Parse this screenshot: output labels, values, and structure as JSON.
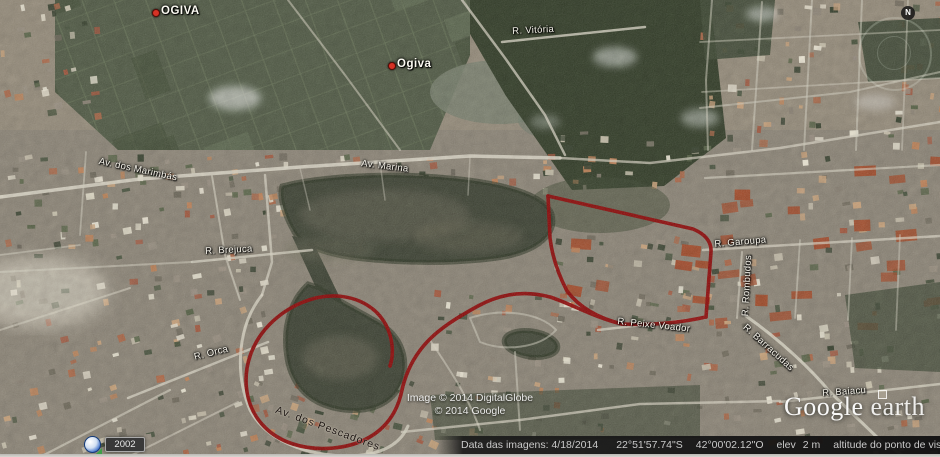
{
  "map": {
    "placemarks": [
      {
        "t": "OGIVA",
        "x": 152,
        "y": 9
      },
      {
        "t": "Ogiva",
        "x": 388,
        "y": 62
      }
    ],
    "street_labels": [
      {
        "t": "Av. dos Marimbás",
        "x": 100,
        "y": 156,
        "r": 12
      },
      {
        "t": "Av. Marina",
        "x": 362,
        "y": 158,
        "r": 7
      },
      {
        "t": "R. Vitória",
        "x": 512,
        "y": 26,
        "r": -3
      },
      {
        "t": "R. Brejuca",
        "x": 205,
        "y": 246,
        "r": -3
      },
      {
        "t": "R. Orca",
        "x": 193,
        "y": 352,
        "r": -14
      },
      {
        "t": "R. Garoupa",
        "x": 714,
        "y": 239,
        "r": -5
      },
      {
        "t": "R. Rombudos",
        "x": 740,
        "y": 316,
        "r": -87
      },
      {
        "t": "R. Peixe Voador",
        "x": 618,
        "y": 316,
        "r": 6
      },
      {
        "t": "R. Barracudas",
        "x": 748,
        "y": 322,
        "r": 42
      },
      {
        "t": "R. Baiacu",
        "x": 822,
        "y": 388,
        "r": -4
      },
      {
        "t": "Av. dos Pescadores",
        "x": 278,
        "y": 404,
        "r": 20,
        "dark": true
      }
    ],
    "watermark": {
      "line1": "Image © 2014 DigitalGlobe",
      "line2": "© 2014 Google"
    },
    "logo": {
      "google": "Google",
      "earth": "earth"
    },
    "compass_n": "N"
  },
  "history_chip": {
    "year": "2002"
  },
  "status_bar": {
    "imagery_date": "Data das imagens: 4/18/2014",
    "latitude": "22°51'57.74\"S",
    "longitude": "42°00'02.12\"O",
    "elev_label": "elev",
    "elev_value": "2 m",
    "eye_alt_label": "altitude do ponto de visão",
    "eye_alt_value": "1.20 km"
  },
  "colors": {
    "boundary_red": "#9a0f0f",
    "road_light": "#d8d3c3",
    "water_dark": "#454b3c",
    "vegetation": "#3a452f",
    "accent_blue": "#2f6fd0"
  }
}
